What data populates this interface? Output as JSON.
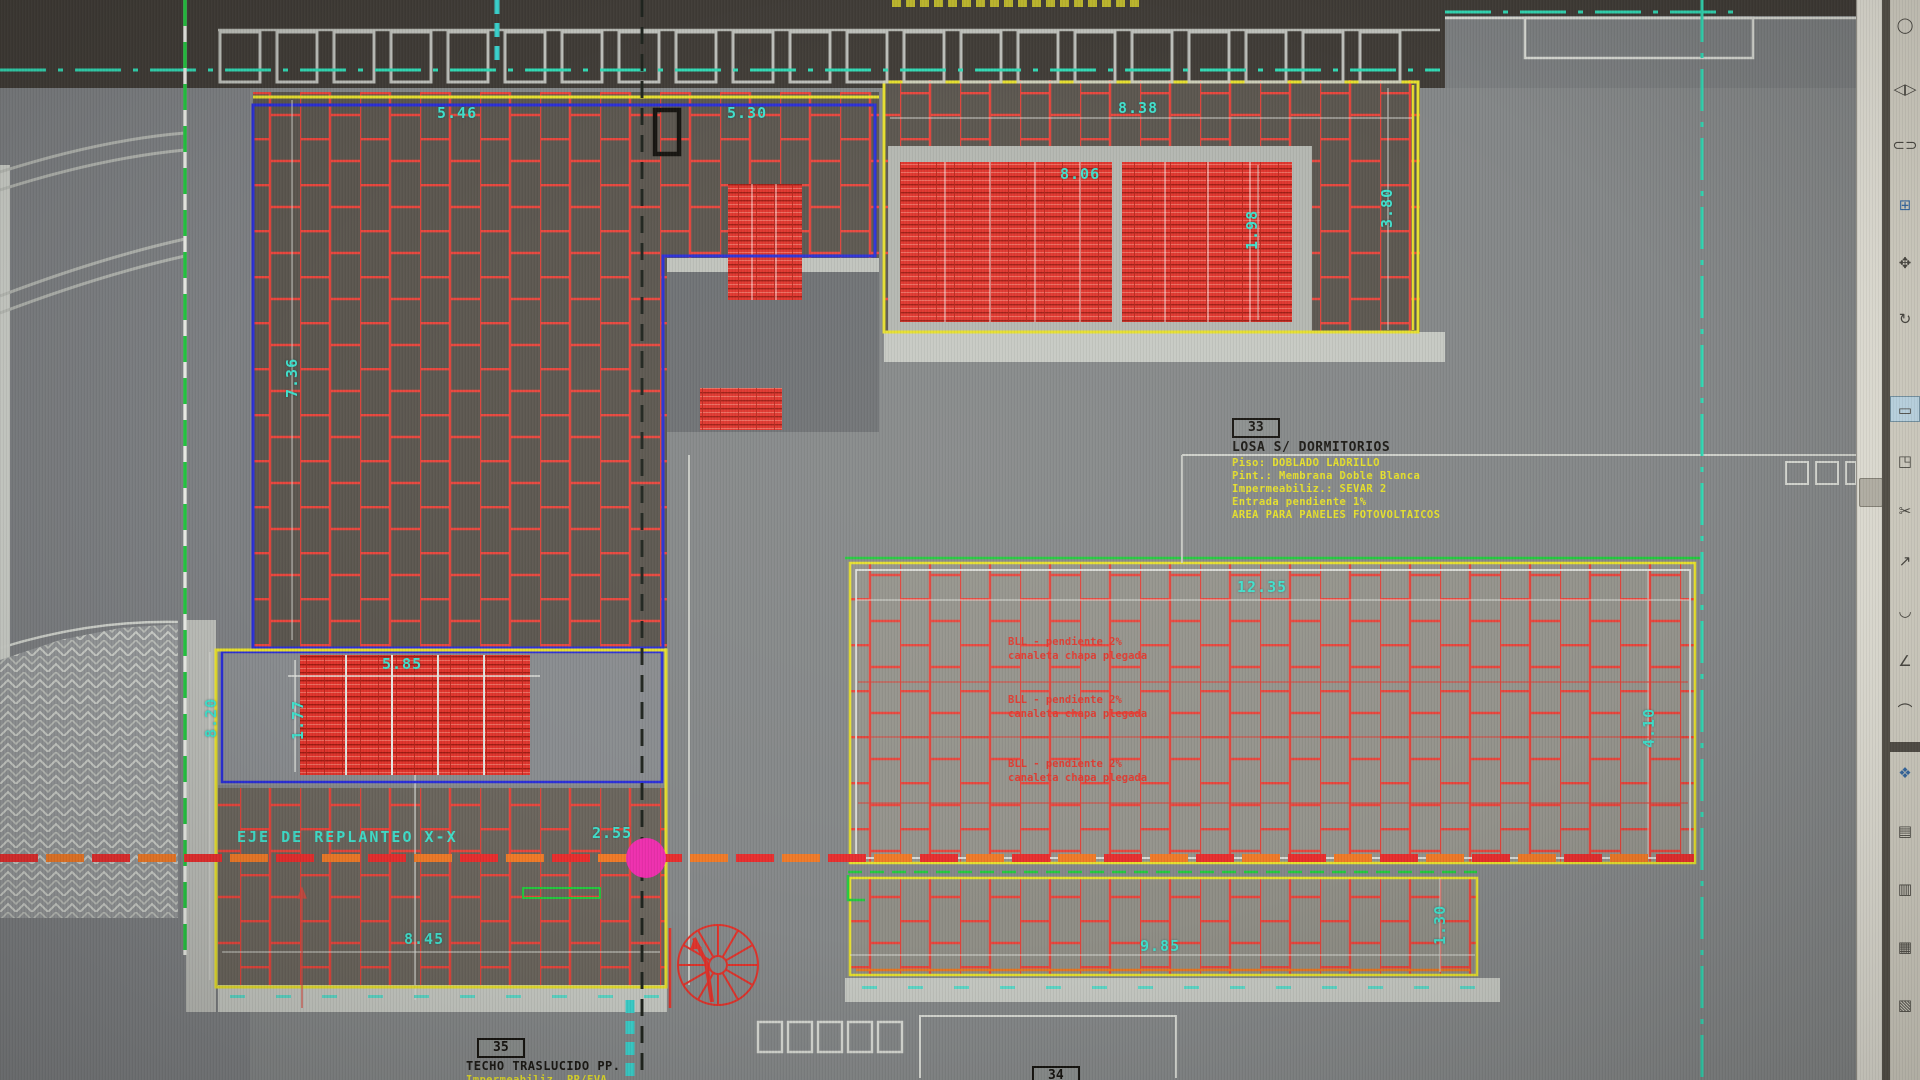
{
  "window": {
    "app_type": "cad-viewport",
    "description": "CAD roof plan drawing with red brick hatch, photovoltaic panel areas and layout axis"
  },
  "drawing": {
    "axis_label": "EJE DE REPLANTEO X-X",
    "dimensions": {
      "dim_5_46": "5.46",
      "dim_5_30": "5.30",
      "dim_8_38": "8.38",
      "dim_8_06": "8.06",
      "dim_1_98": "1.98",
      "dim_3_80": "3.80",
      "dim_7_36": "7.36",
      "dim_12_35": "12.35",
      "dim_4_10": "4.10",
      "dim_5_85": "5.85",
      "dim_1_77": "1.77",
      "dim_8_20": "8.20",
      "dim_2_55": "2.55",
      "dim_8_45": "8.45",
      "dim_9_85": "9.85",
      "dim_1_30": "1.30"
    },
    "labels": {
      "box33": {
        "number": "33",
        "title": "LOSA S/ DORMITORIOS",
        "specs": [
          "Piso: DOBLADO LADRILLO",
          "Pint.: Membrana Doble Blanca",
          "Impermeabiliz.: SEVAR 2",
          "Entrada pendiente 1%",
          "AREA PARA PANELES FOTOVOLTAICOS"
        ]
      },
      "box35": {
        "number": "35",
        "title": "TECHO TRASLUCIDO PP.",
        "spec": "Impermeabiliz. PP/EVA"
      },
      "box34": {
        "number": "34"
      }
    },
    "red_notes": [
      {
        "line1": "BLL - pendiente 2%",
        "line2": "canaleta chapa plegada"
      },
      {
        "line1": "BLL - pendiente 2%",
        "line2": "canaleta chapa plegada"
      },
      {
        "line1": "BLL - pendiente 2%",
        "line2": "canaleta chapa plegada"
      }
    ],
    "colors": {
      "hatch_red": "#e8463d",
      "panel_red": "#e0342c",
      "cyan_text": "#3fe0cc",
      "yellow_note": "#e6e02a",
      "yellow_border": "#e6df2e",
      "blue_border": "#2b2fd8",
      "green_line": "#25c93f",
      "axis_dash_red": "#e82e2e",
      "axis_dash_orange": "#f07a28",
      "magenta_marker": "#ee2fae",
      "dark_band": "#403c37",
      "toolbar_bg": "#d7d4c8"
    }
  },
  "toolbar": {
    "icons": [
      {
        "name": "region-icon",
        "glyph": "◯"
      },
      {
        "name": "mirror-icon",
        "glyph": "◁▷"
      },
      {
        "name": "offset-icon",
        "glyph": "⊂⊃"
      },
      {
        "name": "array-icon",
        "glyph": "⊞",
        "accent": true
      },
      {
        "name": "move-icon",
        "glyph": "✥"
      },
      {
        "name": "rotate-icon",
        "glyph": "↻"
      },
      {
        "name": "scale-icon",
        "glyph": "▭",
        "pressed": true
      },
      {
        "name": "stretch-icon",
        "glyph": "◳"
      },
      {
        "name": "trim-icon",
        "glyph": "✂"
      },
      {
        "name": "extend-icon",
        "glyph": "↗"
      },
      {
        "name": "break-icon",
        "glyph": "◡"
      },
      {
        "name": "chamfer-icon",
        "glyph": "∠"
      },
      {
        "name": "fillet-icon",
        "glyph": "⌒"
      },
      {
        "name": "explode-icon",
        "glyph": "❖",
        "accent": true
      },
      {
        "name": "draworder-front-icon",
        "glyph": "▤"
      },
      {
        "name": "draworder-back-icon",
        "glyph": "▥"
      },
      {
        "name": "draworder-above-icon",
        "glyph": "▦"
      },
      {
        "name": "draworder-below-icon",
        "glyph": "▧"
      }
    ]
  }
}
